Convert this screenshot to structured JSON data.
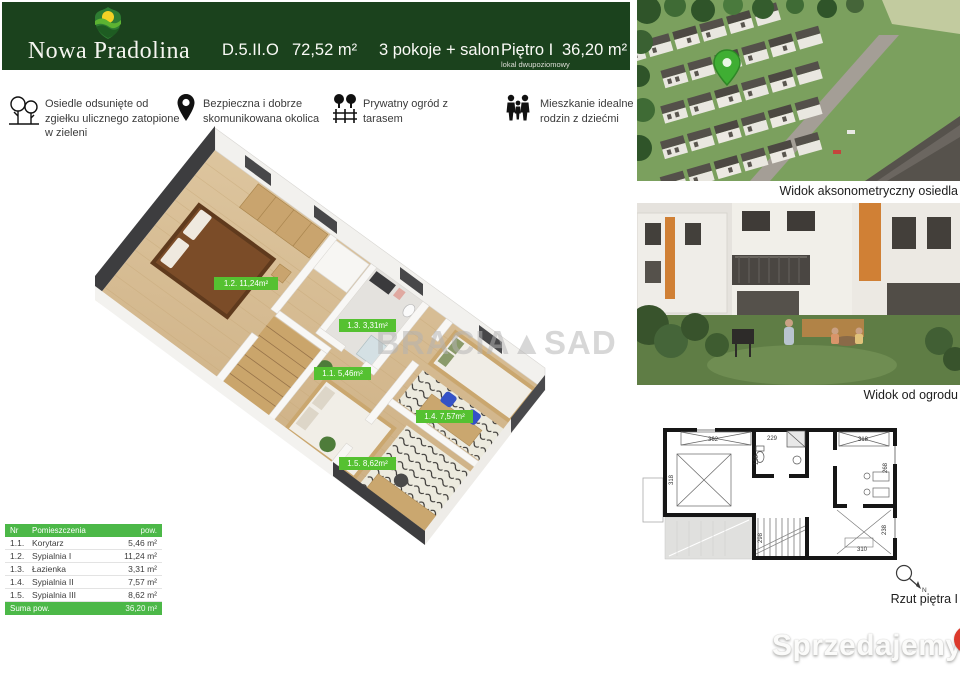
{
  "header": {
    "brand": "Nowa Pradolina",
    "unit_id": "D.5.II.O",
    "total_area": "72,52 m²",
    "rooms": "3 pokoje + salon",
    "floor": "Piętro I",
    "floor_note": "lokal dwupoziomowy",
    "floor_area": "36,20 m²",
    "bg_color": "#1b421d"
  },
  "features": [
    {
      "icon": "trees-icon",
      "text": "Osiedle odsunięte od zgiełku ulicznego zatopione  w zieleni"
    },
    {
      "icon": "location-pin-icon",
      "text": "Bezpieczna i dobrze skomunikowana okolica"
    },
    {
      "icon": "garden-icon",
      "text": "Prywatny ogród z tarasem"
    },
    {
      "icon": "family-icon",
      "text": "Mieszkanie idealne dla rodzin z dziećmi"
    }
  ],
  "floorplan": {
    "watermark": "BRACIA▲SAD",
    "label_color": "#55c131",
    "labels": [
      "1.2. 11,24m²",
      "1.3. 3,31m²",
      "1.1. 5,46m²",
      "1.4. 7,57m²",
      "1.5. 8,62m²"
    ]
  },
  "room_table": {
    "accent_color": "#4cb848",
    "headers": {
      "nr": "Nr",
      "name": "Pomieszczenia",
      "area": "pow."
    },
    "rows": [
      {
        "nr": "1.1.",
        "name": "Korytarz",
        "area": "5,46 m²"
      },
      {
        "nr": "1.2.",
        "name": "Sypialnia I",
        "area": "11,24 m²"
      },
      {
        "nr": "1.3.",
        "name": "Łazienka",
        "area": "3,31 m²"
      },
      {
        "nr": "1.4.",
        "name": "Sypialnia II",
        "area": "7,57 m²"
      },
      {
        "nr": "1.5.",
        "name": "Sypialnia III",
        "area": "8,62 m²"
      }
    ],
    "footer": {
      "label": "Suma pow.",
      "value": "36,20 m²"
    }
  },
  "captions": {
    "photo1": "Widok aksonometryczny osiedla",
    "photo2": "Widok od ogrodu",
    "plan": "Rzut piętra I",
    "compass_n": "N"
  },
  "tech_plan": {
    "dims": {
      "room_left_w": "362",
      "room_left_h": "318",
      "bath_w": "229",
      "bath_h": "150",
      "room_right_w": "318",
      "room_right_h": "268",
      "stairs_h": "298",
      "room_bottom_w": "310",
      "room_bottom_h": "238"
    }
  },
  "brand_watermark": {
    "text": "Sprzedajemy",
    "tld": ".pl"
  }
}
